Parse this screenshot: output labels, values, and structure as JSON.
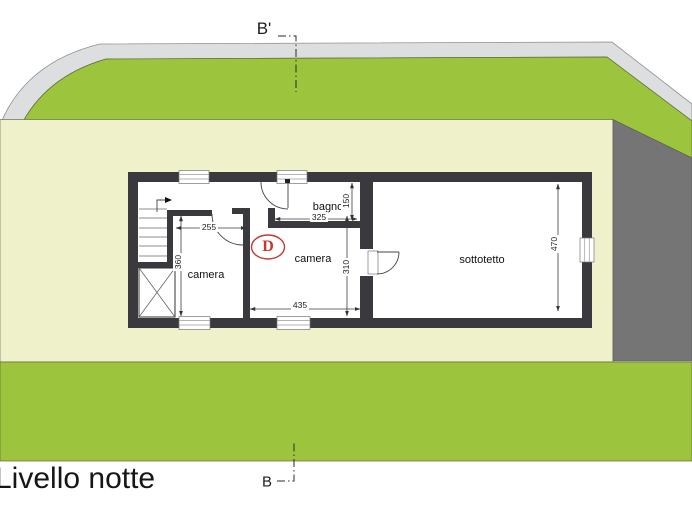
{
  "page": {
    "title": "Livello notte",
    "section_top_label": "B'",
    "section_bottom_label": "B"
  },
  "plan": {
    "rooms": {
      "camera_left": {
        "label": "camera"
      },
      "camera_center": {
        "label": "camera"
      },
      "bagno": {
        "label": "bagno"
      },
      "sottotetto": {
        "label": "sottotetto"
      }
    },
    "door_type_marker": {
      "label": "D"
    },
    "dimensions": {
      "camera_left_width_cm": "255",
      "camera_left_height_cm": "360",
      "camera_center_width_cm": "435",
      "camera_center_height_cm": "310",
      "bagno_width_cm": "325",
      "bagno_height_cm": "150",
      "sottotetto_height_cm": "470"
    }
  },
  "colors": {
    "garden_green": "#9cc43d",
    "lot_pale": "#eff1cb",
    "road_gray": "#dcdee0",
    "neighbor_dark_gray": "#757575",
    "wall_dark": "#3a3a3e",
    "door_marker_red": "#c23a30"
  }
}
